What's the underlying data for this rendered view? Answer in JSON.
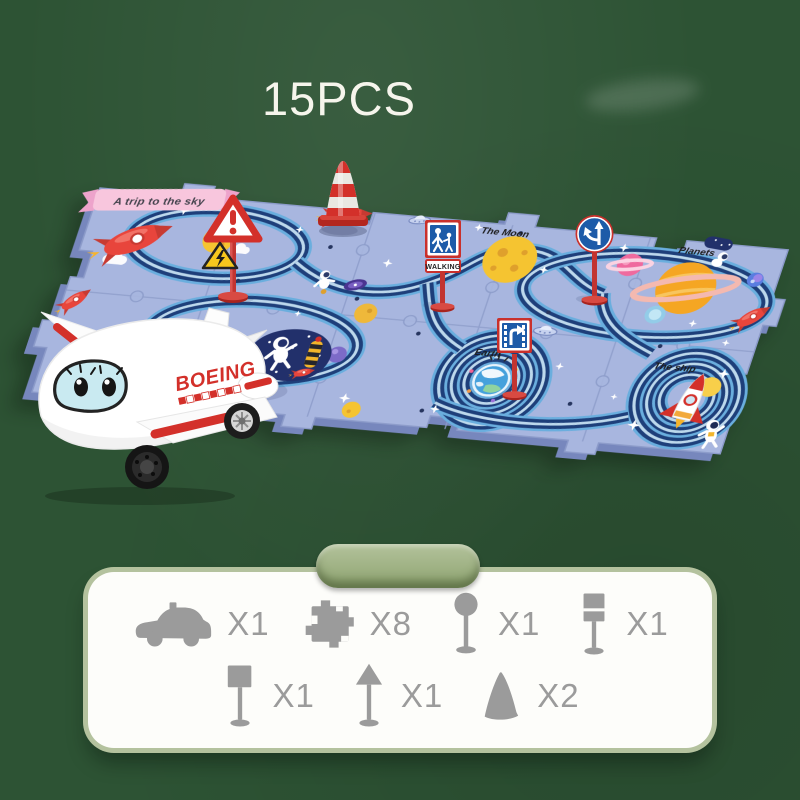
{
  "page": {
    "count_label": "15PCS",
    "background_color": "#2d5334"
  },
  "mat": {
    "banner_label": "A trip to the sky",
    "labels": {
      "moon": "The Moon",
      "planets": "Planets",
      "earth": "Earth",
      "ship": "The ship"
    },
    "sign_labels": {
      "walking": "WALKING"
    },
    "colors": {
      "base": "#a8b6df",
      "road": "#1e3f7a",
      "road_edge": "#6aaede",
      "seam": "#8d9cca"
    }
  },
  "plane": {
    "brand_label": "BOEING",
    "body_color": "#ffffff",
    "accent_color": "#d3302a",
    "window_color": "#c9eaf1"
  },
  "parts_panel": {
    "tab_color": "#9fb381",
    "icon_color": "#9b9b9b",
    "items": [
      {
        "name": "toy-vehicle",
        "icon": "car-icon",
        "count_label": "X1"
      },
      {
        "name": "puzzle-track-piece",
        "icon": "puzzle-piece-icon",
        "count_label": "X8"
      },
      {
        "name": "round-sign",
        "icon": "round-sign-icon",
        "count_label": "X1"
      },
      {
        "name": "slot-sign",
        "icon": "slot-sign-icon",
        "count_label": "X1"
      },
      {
        "name": "square-sign",
        "icon": "square-sign-icon",
        "count_label": "X1"
      },
      {
        "name": "arrow-sign",
        "icon": "arrow-sign-icon",
        "count_label": "X1"
      },
      {
        "name": "traffic-cone",
        "icon": "cone-icon",
        "count_label": "X2"
      }
    ]
  }
}
